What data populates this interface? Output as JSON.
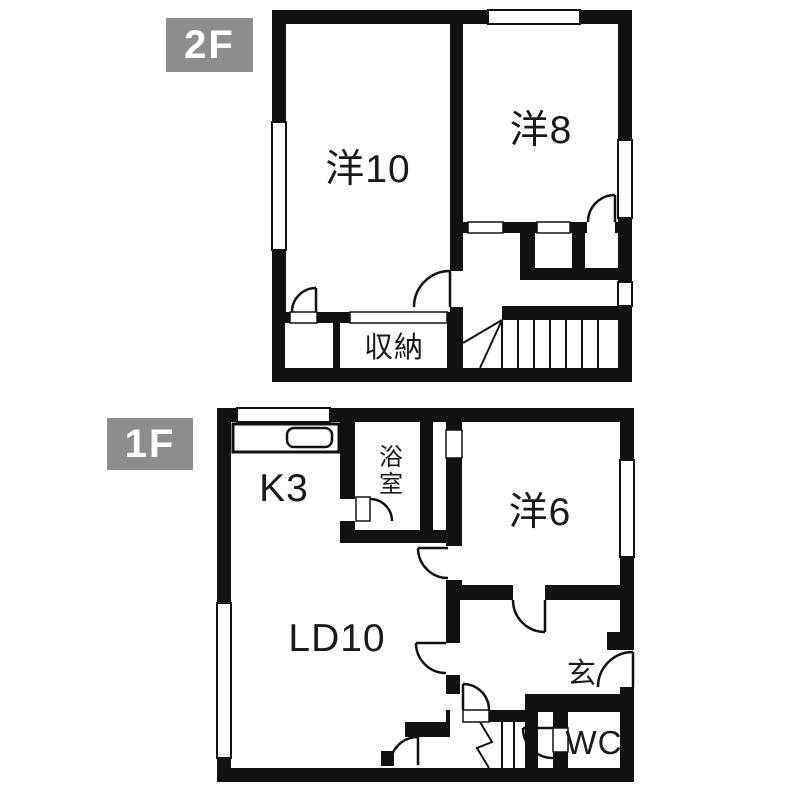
{
  "title": "間取り図",
  "colors": {
    "wall": "#111111",
    "background": "#ffffff",
    "badge_bg": "#8d8d8d",
    "badge_text": "#ffffff",
    "text": "#1a1a1a"
  },
  "floor2": {
    "badge": "2F",
    "rooms": [
      {
        "id": "western-room-10",
        "label": "洋10"
      },
      {
        "id": "western-room-8",
        "label": "洋8"
      },
      {
        "id": "storage",
        "label": "収納"
      }
    ]
  },
  "floor1": {
    "badge": "1F",
    "rooms": [
      {
        "id": "kitchen-3",
        "label": "K3"
      },
      {
        "id": "bathroom",
        "label": "浴室"
      },
      {
        "id": "western-room-6",
        "label": "洋6"
      },
      {
        "id": "living-dining-10",
        "label": "LD10"
      },
      {
        "id": "entrance",
        "label": "玄"
      },
      {
        "id": "toilet",
        "label": "WC"
      }
    ]
  }
}
